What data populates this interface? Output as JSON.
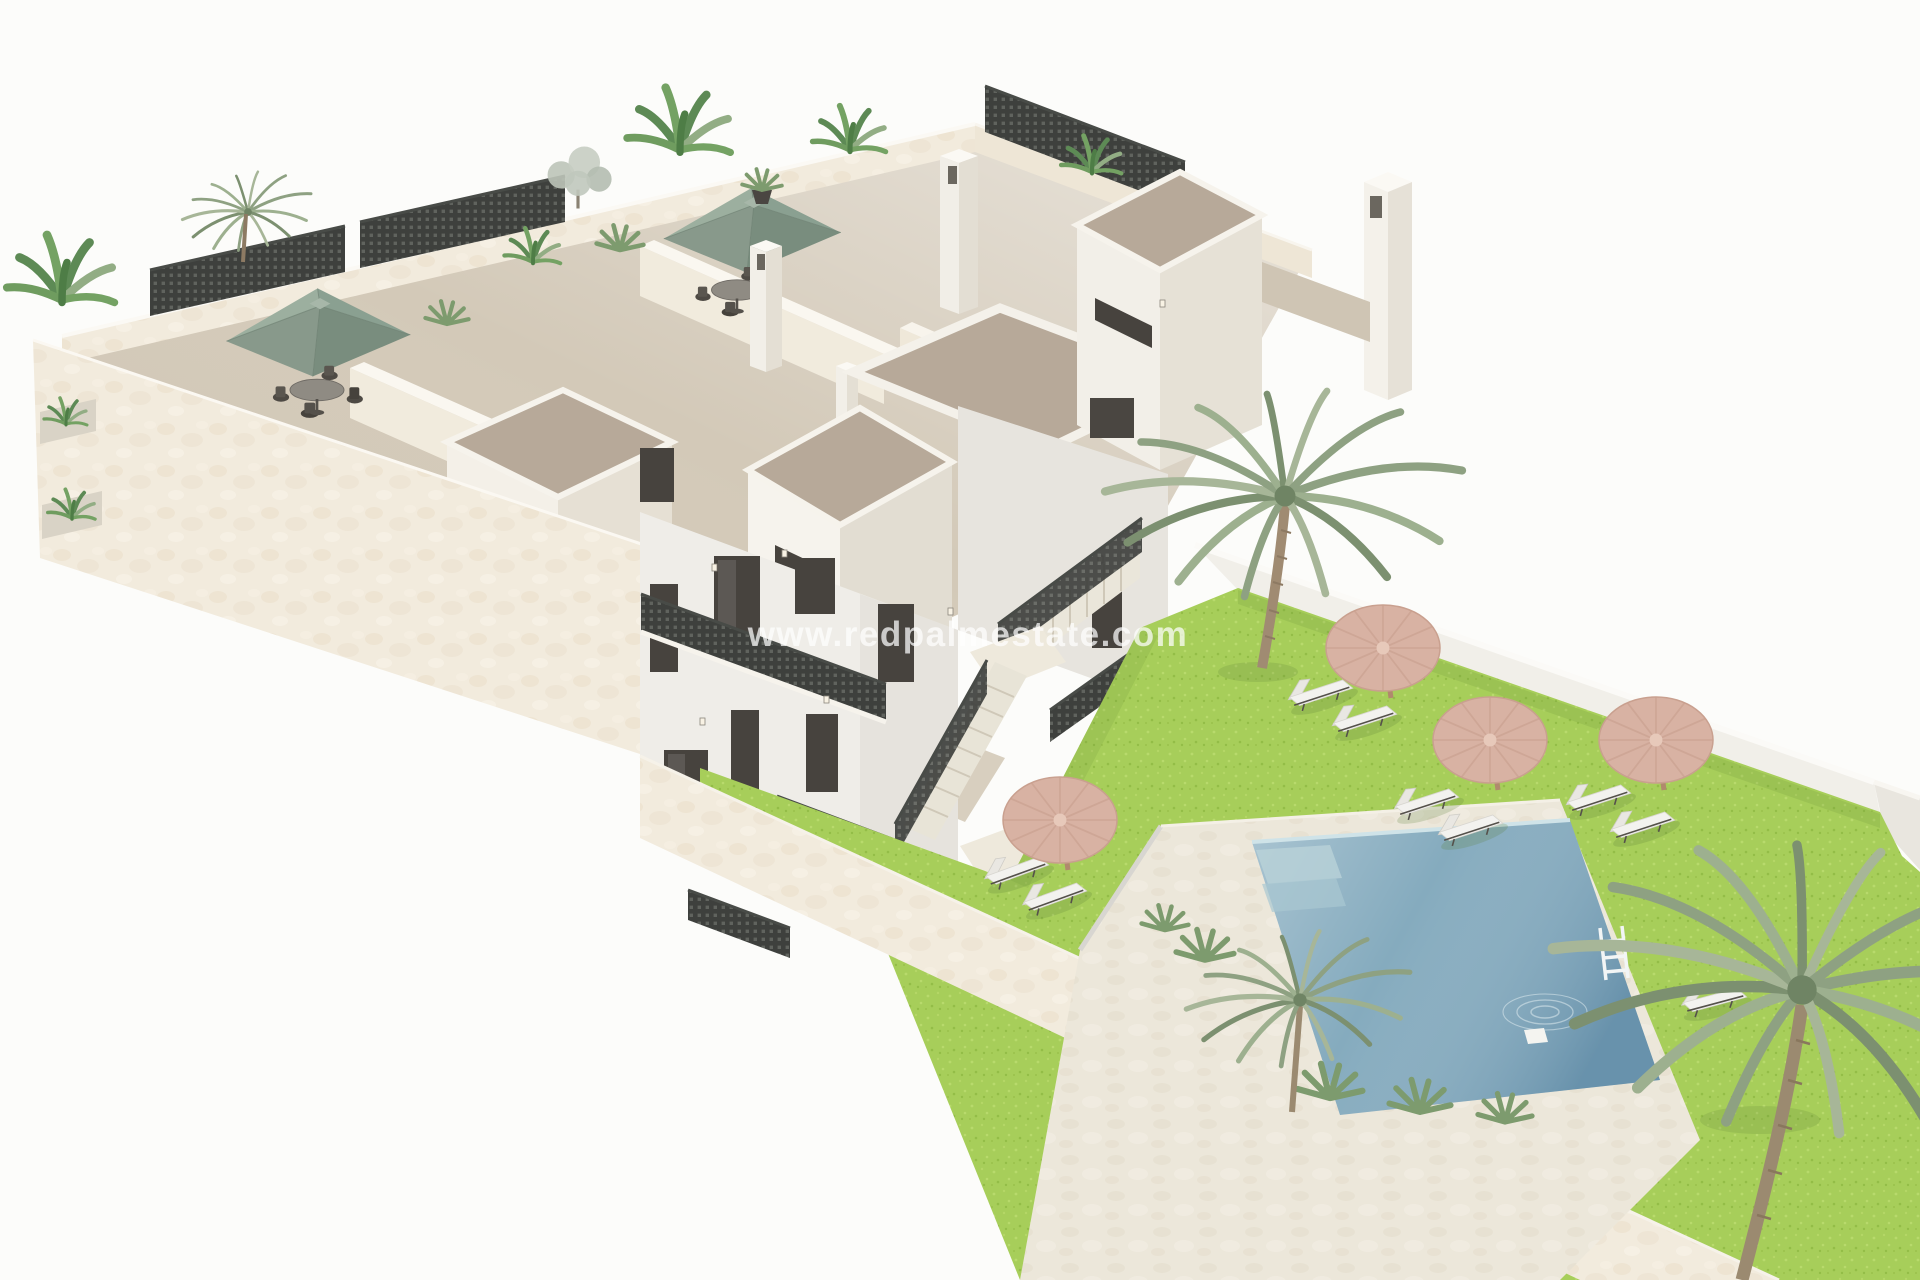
{
  "meta": {
    "description": "Aerial 3D architectural render of a modern white apartment building with rooftop terraces, a landscaped garden, straw parasols, sun loungers and a private pool",
    "style": "isometric 3D visualisation on white background"
  },
  "watermark": {
    "text": "www.redpalmestate.com",
    "color": "#ffffff",
    "opacity": "0.72"
  },
  "palette": {
    "background": "#fcfcfa",
    "facade_cream": "#f2ebdd",
    "wall_white": "#efede8",
    "wall_shade": "#e7e4de",
    "terrace_floor": "#d3c9b8",
    "tower_roof": "#b7a999",
    "window_dark": "#47433e",
    "railing_dark": "#3e403d",
    "umbrella_sage": "#9caf9f",
    "umbrella_sage_shade": "#798d7e",
    "umbrella_straw": "#d8b2a3",
    "umbrella_straw_edge": "#c79e8c",
    "lawn_green": "#a7ce5a",
    "lawn_light": "#b8da6c",
    "lawn_dark": "#93bd47",
    "pool_deck": "#ece7da",
    "pool_water": "#85abbe",
    "pool_water_deep": "#6e9ab2",
    "palm_green": "#8ea182",
    "palm_trunk": "#a08b72",
    "lounger_white": "#f3f2ef",
    "dining_dark": "#4e4a44"
  },
  "scene": {
    "building": {
      "storeys": 3,
      "rooftop_terraces": true,
      "sage_parasols": 2,
      "dining_sets": 2,
      "chimneys": 3,
      "lattice_railings": true,
      "external_staircase": true,
      "facade_planters": 2
    },
    "garden": {
      "straw_parasols": 4,
      "sun_loungers": 9,
      "palm_trees": 3,
      "perimeter_wall": true,
      "lawn": true
    },
    "pool": {
      "shape": "rectangular",
      "ladder": true,
      "corner_steps": true,
      "deck_material": "stone"
    }
  }
}
